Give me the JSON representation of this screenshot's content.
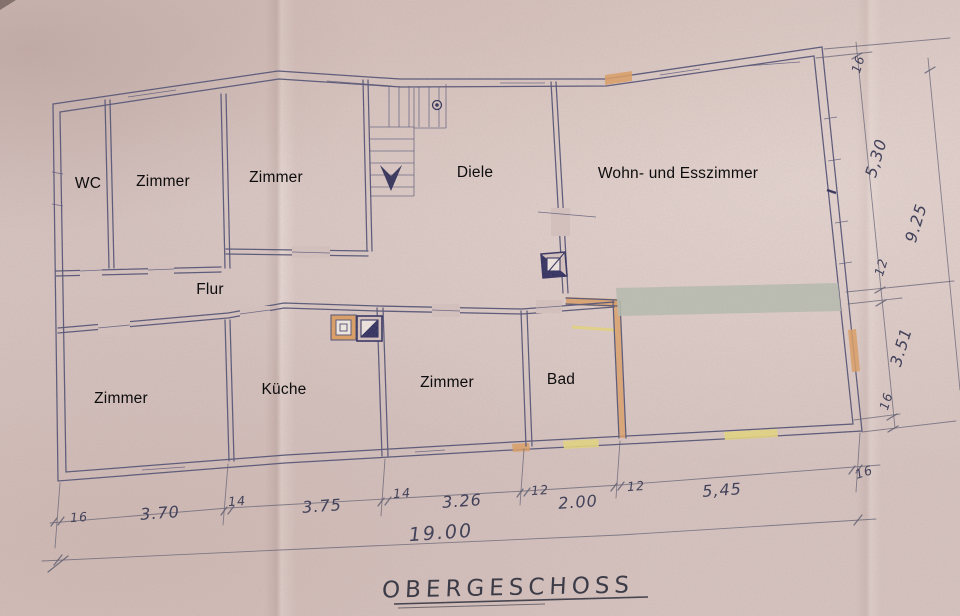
{
  "title": "OBERGESCHOSS",
  "floor_plan": {
    "rooms": [
      {
        "id": "wc",
        "label": "WC"
      },
      {
        "id": "zimmer-top-1",
        "label": "Zimmer"
      },
      {
        "id": "zimmer-top-2",
        "label": "Zimmer"
      },
      {
        "id": "diele",
        "label": "Diele"
      },
      {
        "id": "wohn-esszimmer",
        "label": "Wohn- und Esszimmer"
      },
      {
        "id": "flur",
        "label": "Flur"
      },
      {
        "id": "zimmer-bottom-left",
        "label": "Zimmer"
      },
      {
        "id": "kueche",
        "label": "Küche"
      },
      {
        "id": "zimmer-bottom-mid",
        "label": "Zimmer"
      },
      {
        "id": "bad",
        "label": "Bad"
      }
    ],
    "dimensions_bottom": [
      "16",
      "3.70",
      "14",
      "3.75",
      "14",
      "3.26",
      "12",
      "2.00",
      "12",
      "5,45",
      "16"
    ],
    "dimension_bottom_total": "19.00",
    "dimensions_right": [
      "16",
      "5,30",
      "12",
      "3.51",
      "16"
    ],
    "dimension_right_total": "9.25"
  },
  "colors": {
    "paper": "#d6c3c0",
    "pencil": "#565678",
    "pencil_light": "#5c5c70",
    "ink_dark": "#31315a",
    "orange": "#dd9f63",
    "yellow": "#e6d77f",
    "blue_chimney": "#2f2f60",
    "redaction": "#b7bdb0",
    "label_text": "#0c0c0c",
    "hand_text": "#42425a"
  }
}
